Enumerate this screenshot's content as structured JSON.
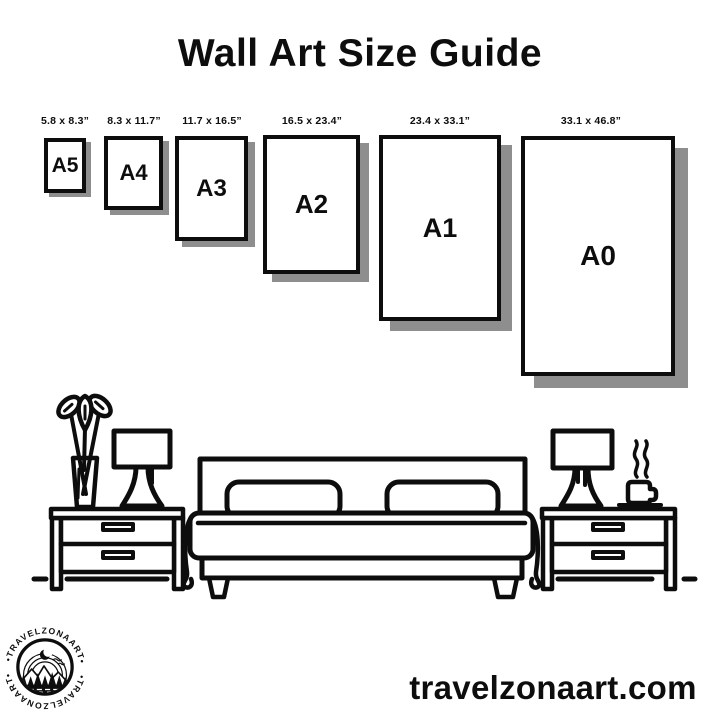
{
  "title": "Wall Art Size Guide",
  "sizes": [
    {
      "name": "A5",
      "dimensions": "5.8 x 8.3”"
    },
    {
      "name": "A4",
      "dimensions": "8.3 x 11.7”"
    },
    {
      "name": "A3",
      "dimensions": "11.7 x 16.5”"
    },
    {
      "name": "A2",
      "dimensions": "16.5 x 23.4”"
    },
    {
      "name": "A1",
      "dimensions": "23.4 x 33.1”"
    },
    {
      "name": "A0",
      "dimensions": "33.1 x 46.8”"
    }
  ],
  "logo": {
    "brand_top": "•TRAVELZONAART•",
    "brand_bottom": "•TRAVELZONAART•"
  },
  "website": "travelzonaart.com",
  "colors": {
    "ink": "#0d0d0d",
    "frame_shadow": "#8e8e8e",
    "background": "#ffffff"
  }
}
